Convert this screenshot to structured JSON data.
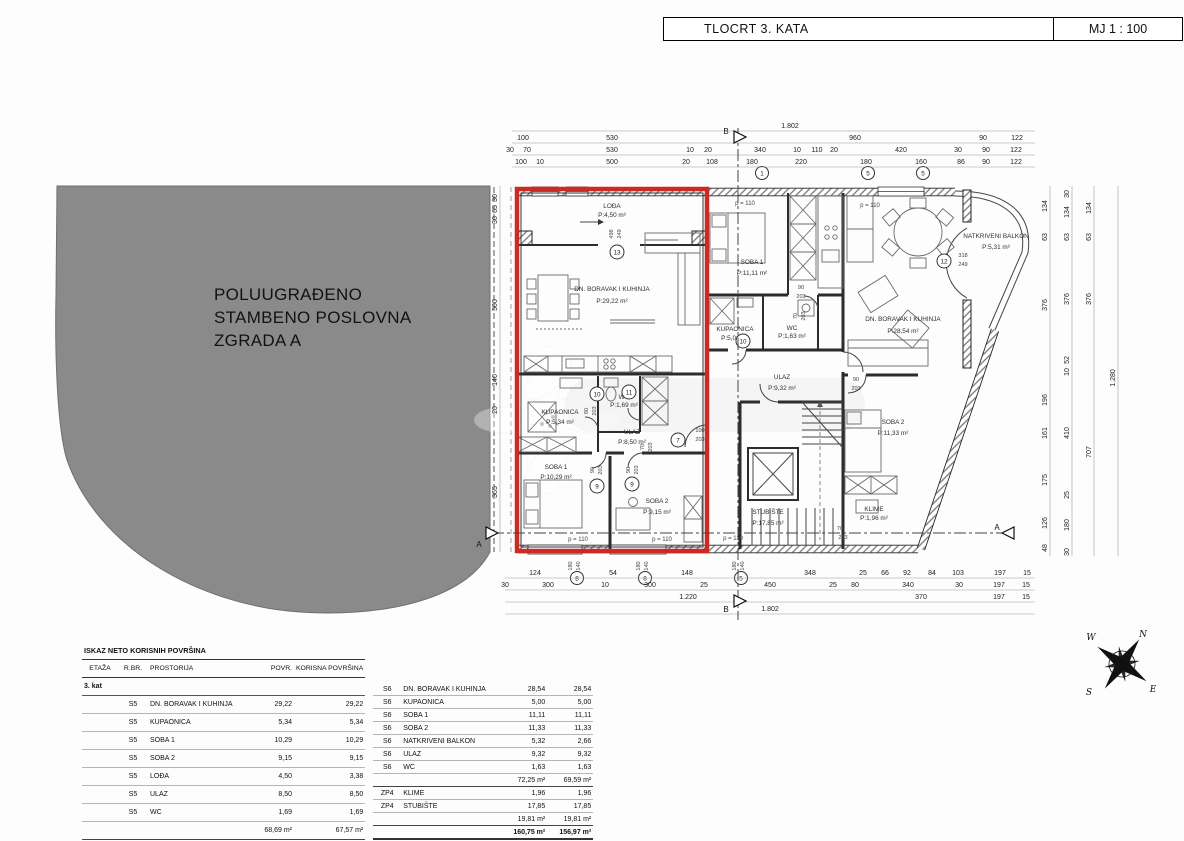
{
  "colors": {
    "accent_red": "#cc2b24",
    "site_gray": "#8a8a8a"
  },
  "title_block": {
    "title": "TLOCRT 3. KATA",
    "scale": "MJ 1 : 100"
  },
  "site": {
    "line1": "POLUUGRAĐENO",
    "line2": "STAMBENO POSLOVNA",
    "line3": "ZGRADA A"
  },
  "compass": {
    "n": "N",
    "e": "E",
    "s": "S",
    "w": "W"
  },
  "plan": {
    "parapet": "p = 110",
    "rooms": {
      "lodja": {
        "name": "LOĐA",
        "area": "P:4,50 m²"
      },
      "dnevni5": {
        "name": "DN. BORAVAK I KUHINJA",
        "area": "P:29,22 m²"
      },
      "kupa5": {
        "name": "KUPAONICA",
        "area": "P:5,34 m²"
      },
      "wc5": {
        "name": "WC",
        "area": "P:1,69 m²"
      },
      "ulaz5": {
        "name": "ULAZ",
        "area": "P:8,50 m²"
      },
      "soba1_5": {
        "name": "SOBA 1",
        "area": "P:10,29 m²"
      },
      "soba2_5": {
        "name": "SOBA 2",
        "area": "P:9,15 m²"
      },
      "soba1_6": {
        "name": "SOBA 1",
        "area": "P:11,11 m²"
      },
      "kupa6": {
        "name": "KUPAONICA",
        "area": "P:5,00 m²"
      },
      "wc6": {
        "name": "WC",
        "area": "P:1,63 m²"
      },
      "ulaz6": {
        "name": "ULAZ",
        "area": "P:9,32 m²"
      },
      "soba2_6": {
        "name": "SOBA 2",
        "area": "P:11,33 m²"
      },
      "dnevni6": {
        "name": "DN. BORAVAK I KUHINJA",
        "area": "P:28,54 m²"
      },
      "balkon": {
        "name": "NATKRIVENI BALKON",
        "area": "P:5,31 m²"
      },
      "stubiste": {
        "name": "STUBIŠTE",
        "area": "P:17,85 m²"
      },
      "klime": {
        "name": "KLIME",
        "area": "P:1,96 m²"
      }
    },
    "markers": {
      "a": "A",
      "b": "B"
    },
    "circles": {
      "c13": "13",
      "c12": "12",
      "c11": "11",
      "c10": "10",
      "c9": "9",
      "c8": "8",
      "c7": "7",
      "c5": "5",
      "c1": "1"
    },
    "tags": {
      "t498": "498",
      "t318": "318",
      "t249": "249",
      "t203": "203",
      "t180": "180",
      "t160": "160",
      "t140": "140",
      "t100": "100",
      "t90": "90",
      "t80": "80",
      "t70": "70"
    }
  },
  "dims": {
    "top1": [
      "1.802"
    ],
    "top2": [
      "100",
      "530",
      "960",
      "90",
      "122"
    ],
    "top3": [
      "30",
      "70",
      "530",
      "10",
      "20",
      "340",
      "10",
      "110",
      "20",
      "420",
      "30",
      "90",
      "122"
    ],
    "top4": [
      "100",
      "10",
      "500",
      "20",
      "108",
      "180",
      "220",
      "180",
      "160",
      "86",
      "90",
      "122"
    ],
    "bottom1": [
      "124",
      "54",
      "148",
      "348",
      "25",
      "66",
      "92",
      "84",
      "103",
      "197",
      "15"
    ],
    "bottom2": [
      "30",
      "300",
      "10",
      "300",
      "25",
      "450",
      "25",
      "80",
      "340",
      "30",
      "197",
      "15"
    ],
    "bottom3": [
      "1.220",
      "370",
      "197",
      "15"
    ],
    "bottom4": [
      "1.802"
    ],
    "right1": [
      "134",
      "63",
      "376",
      "196",
      "161",
      "175",
      "126",
      "48"
    ],
    "right2": [
      "30",
      "134",
      "63",
      "376",
      "52",
      "10",
      "410",
      "25",
      "180",
      "30"
    ],
    "right3": [
      "134",
      "63",
      "376",
      "707"
    ],
    "right4": [
      "1.280"
    ],
    "left1": [
      "30",
      "65",
      "30",
      "500",
      "140",
      "20",
      "365"
    ]
  },
  "table": {
    "title": "ISKAZ NETO KORISNIH POVRŠINA",
    "col_etaza": "ETAŽA",
    "col_rbr": "R.BR.",
    "col_prostorija": "PROSTORIJA",
    "col_povr": "POVR.",
    "col_korisna": "KORISNA POVRŠINA",
    "floor": "3. kat",
    "left_rows": [
      {
        "rbr": "S5",
        "name": "DN. BORAVAK I KUHINJA",
        "povr": "29,22",
        "kor": "29,22"
      },
      {
        "rbr": "S5",
        "name": "KUPAONICA",
        "povr": "5,34",
        "kor": "5,34"
      },
      {
        "rbr": "S5",
        "name": "SOBA 1",
        "povr": "10,29",
        "kor": "10,29"
      },
      {
        "rbr": "S5",
        "name": "SOBA 2",
        "povr": "9,15",
        "kor": "9,15"
      },
      {
        "rbr": "S5",
        "name": "LOĐA",
        "povr": "4,50",
        "kor": "3,38"
      },
      {
        "rbr": "S5",
        "name": "ULAZ",
        "povr": "8,50",
        "kor": "8,50"
      },
      {
        "rbr": "S5",
        "name": "WC",
        "povr": "1,69",
        "kor": "1,69"
      }
    ],
    "left_total": {
      "povr": "68,69 m²",
      "kor": "67,57 m²"
    },
    "right_rows": [
      {
        "rbr": "S6",
        "name": "DN. BORAVAK I KUHINJA",
        "povr": "28,54",
        "kor": "28,54"
      },
      {
        "rbr": "S6",
        "name": "KUPAONICA",
        "povr": "5,00",
        "kor": "5,00"
      },
      {
        "rbr": "S6",
        "name": "SOBA 1",
        "povr": "11,11",
        "kor": "11,11"
      },
      {
        "rbr": "S6",
        "name": "SOBA 2",
        "povr": "11,33",
        "kor": "11,33"
      },
      {
        "rbr": "S6",
        "name": "NATKRIVENI BALKON",
        "povr": "5,32",
        "kor": "2,66"
      },
      {
        "rbr": "S6",
        "name": "ULAZ",
        "povr": "9,32",
        "kor": "9,32"
      },
      {
        "rbr": "S6",
        "name": "WC",
        "povr": "1,63",
        "kor": "1,63"
      }
    ],
    "right_subtotal": {
      "povr": "72,25 m²",
      "kor": "69,59 m²"
    },
    "zp_rows": [
      {
        "rbr": "ZP4",
        "name": "KLIME",
        "povr": "1,96",
        "kor": "1,96"
      },
      {
        "rbr": "ZP4",
        "name": "STUBIŠTE",
        "povr": "17,85",
        "kor": "17,85"
      }
    ],
    "zp_subtotal": {
      "povr": "19,81 m²",
      "kor": "19,81 m²"
    },
    "grand_total": {
      "povr": "160,75 m²",
      "kor": "156,97 m²"
    }
  }
}
